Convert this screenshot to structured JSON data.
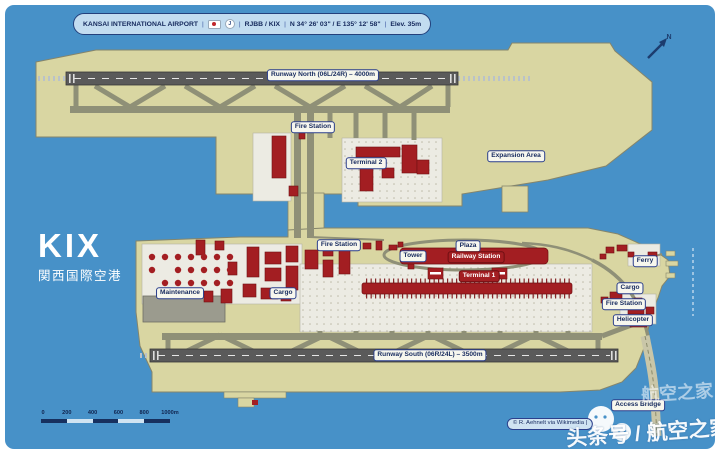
{
  "header": {
    "airport_name": "KANSAI INTERNATIONAL AIRPORT",
    "separator": "|",
    "codes": "RJBB / KIX",
    "coordinates": "N 34° 26' 03\" / E 135° 12' 58\"",
    "elevation": "Elev. 35m",
    "flag_icon": "japan-flag",
    "roundel_icon": "J"
  },
  "title": {
    "code": "KIX",
    "name_ja": "関西国際空港"
  },
  "north_indicator": {
    "label": "N"
  },
  "labels": {
    "runway_north": "Runway North (06L/24R) – 4000m",
    "runway_south": "Runway South (06R/24L) – 3500m",
    "fire_station_north": "Fire Station",
    "terminal2": "Terminal 2",
    "expansion_area": "Expansion Area",
    "fire_station_main": "Fire Station",
    "tower": "Tower",
    "plaza": "Plaza",
    "railway_station": "Railway Station",
    "terminal1": "Terminal 1",
    "maintenance": "Maintenance",
    "cargo_west": "Cargo",
    "ferry": "Ferry",
    "cargo_east": "Cargo",
    "fire_station_east": "Fire Station",
    "helicopter": "Helicopter",
    "access_bridge": "Access Bridge"
  },
  "scale_bar": {
    "ticks": [
      "0",
      "200",
      "400",
      "600",
      "800",
      "1000m"
    ]
  },
  "credit": "© R. Aehnelt via Wikimedia |",
  "watermark": {
    "brand": "航空之家",
    "byline": "头条号 / 航空之家",
    "icon": "chat-bubbles-icon"
  },
  "colors": {
    "sea": "#4791c8",
    "island": "#d9d6a2",
    "runway": "#5a5a5a",
    "taxiway": "#8f9077",
    "apron": "#ecebe3",
    "building_red": "#a31e22",
    "label_navy": "#15295e",
    "header_blue": "#c2dcf0"
  }
}
